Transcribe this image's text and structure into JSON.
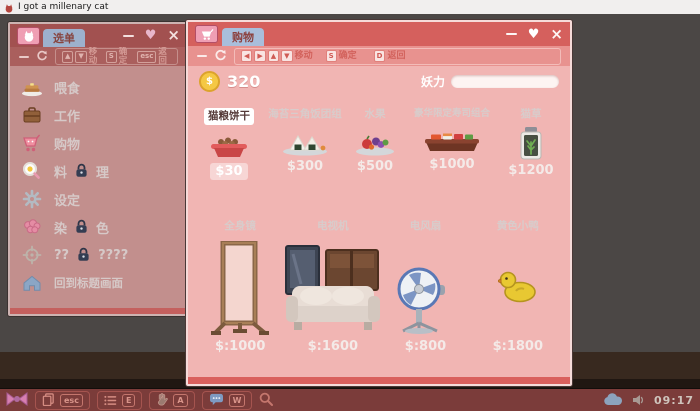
{
  "os": {
    "title": "I got a millenary cat",
    "clock": "09:17"
  },
  "glyphs": {
    "minimize": "—",
    "heart": "♥",
    "close": "×",
    "coin_symbol": "$"
  },
  "menu_window": {
    "tab": "选单",
    "toolbar": {
      "keys": [
        "▲",
        "▼"
      ],
      "move": "移动",
      "confirm_key": "S",
      "confirm": "确定",
      "back_key": "esc",
      "back": "返回"
    },
    "items": [
      {
        "label": "喂食",
        "icon": "pancake-icon",
        "locked": false
      },
      {
        "label": "工作",
        "icon": "briefcase-icon",
        "locked": false
      },
      {
        "label": "购物",
        "icon": "cart-icon",
        "locked": false
      },
      {
        "label_left": "料",
        "label_right": "理",
        "icon": "egg-magnifier-icon",
        "locked": true
      },
      {
        "label": "设定",
        "icon": "gear-icon",
        "locked": false
      },
      {
        "label_left": "染",
        "label_right": "色",
        "icon": "brain-icon",
        "locked": true
      },
      {
        "label_left": "??",
        "label_right": "????",
        "icon": "crosshair-icon",
        "locked": true
      },
      {
        "label": "回到标题画面",
        "icon": "home-icon",
        "locked": false
      }
    ]
  },
  "shop_window": {
    "tab": "购物",
    "toolbar": {
      "keys": [
        "◀",
        "▶",
        "▲",
        "▼"
      ],
      "move": "移动",
      "confirm_key": "S",
      "confirm": "确定",
      "back_key": "D",
      "back": "返回"
    },
    "money": "320",
    "power_label": "妖力",
    "food_items": [
      {
        "name": "猫粮饼干",
        "price": "$30",
        "selected": true,
        "icon": "cat-food-bowl"
      },
      {
        "name": "海苔三角饭团组",
        "price": "$300",
        "selected": false,
        "icon": "onigiri-plate"
      },
      {
        "name": "水果",
        "price": "$500",
        "selected": false,
        "icon": "fruit-plate"
      },
      {
        "name": "豪华限定寿司组合",
        "price": "$1000",
        "selected": false,
        "icon": "sushi-platter"
      },
      {
        "name": "猫草",
        "price": "$1200",
        "selected": false,
        "icon": "cat-grass-jar"
      }
    ],
    "furniture_items": [
      {
        "name": "全身镜",
        "price": "$:1000",
        "icon": "full-body-mirror"
      },
      {
        "name": "电视机",
        "price": "$:1600",
        "icon": "tv-set"
      },
      {
        "name": "电风扇",
        "price": "$:800",
        "icon": "electric-fan"
      },
      {
        "name": "黄色小鸭",
        "price": "$:1800",
        "icon": "yellow-duck"
      }
    ]
  },
  "taskbar": {
    "keycaps": {
      "menu": "esc",
      "list": "E",
      "hand": "A",
      "chat": "W"
    }
  },
  "colors": {
    "active_titlebar": "#d5605d",
    "inactive_titlebar": "#a25150",
    "shop_body": "#f1b5b3",
    "menu_body": "#c28f8d",
    "tab_blue": "#a9bedb",
    "taskbar": "#7b3c3a",
    "coin_gold": "#f5c844",
    "game_background": "#4b4745",
    "floor_brown": "#38291f"
  }
}
